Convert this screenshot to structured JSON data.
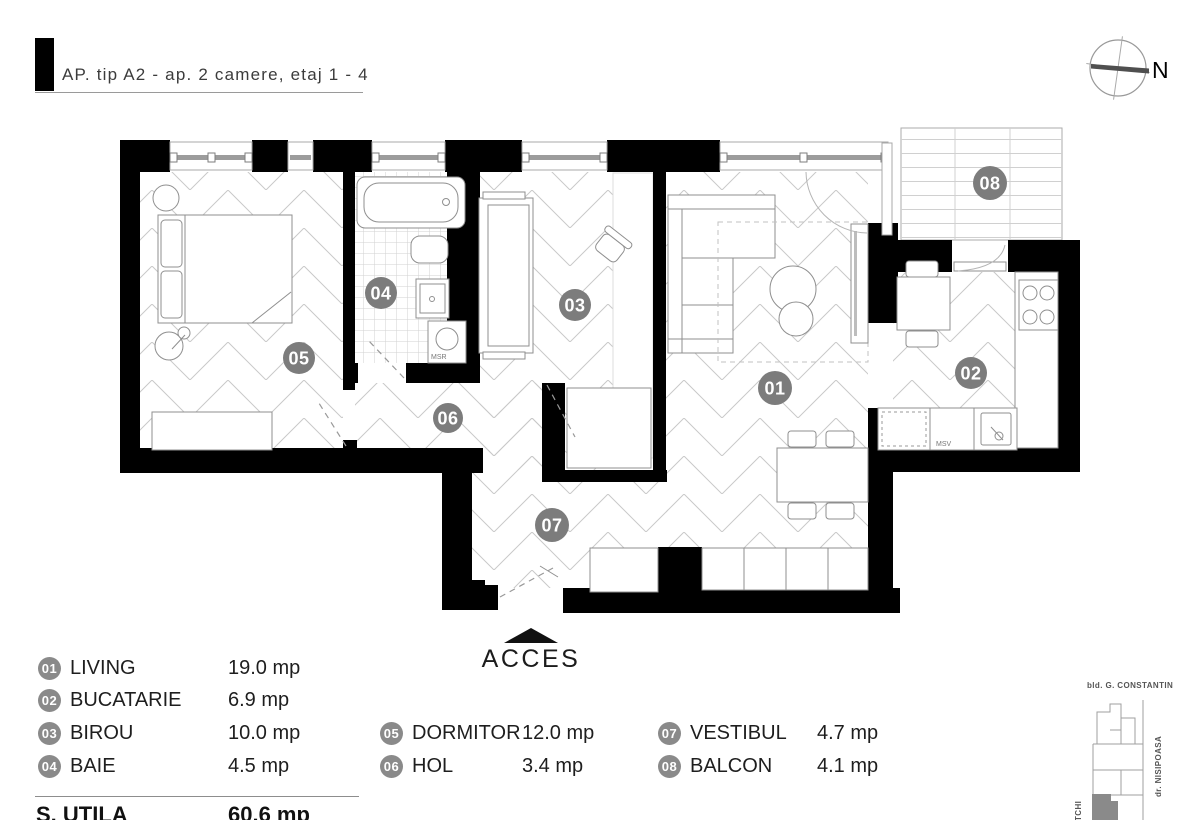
{
  "header": {
    "title": "AP. tip A2 - ap. 2 camere, etaj 1 - 4"
  },
  "compass": {
    "north_label": "N"
  },
  "rooms": [
    {
      "num": "01",
      "name": "LIVING",
      "area": "19.0 mp"
    },
    {
      "num": "02",
      "name": "BUCATARIE",
      "area": "6.9 mp"
    },
    {
      "num": "03",
      "name": "BIROU",
      "area": "10.0 mp"
    },
    {
      "num": "04",
      "name": "BAIE",
      "area": "4.5 mp"
    },
    {
      "num": "05",
      "name": "DORMITOR",
      "area": "12.0 mp"
    },
    {
      "num": "06",
      "name": "HOL",
      "area": "3.4 mp"
    },
    {
      "num": "07",
      "name": "VESTIBUL",
      "area": "4.7 mp"
    },
    {
      "num": "08",
      "name": "BALCON",
      "area": "4.1 mp"
    }
  ],
  "plan": {
    "washer_label": "MSR",
    "dishwasher_label": "MSV",
    "access_label": "ACCES"
  },
  "total": {
    "label": "S. UTILA",
    "value": "60.6 mp"
  },
  "sitemap": {
    "street_top": "bld. G. CONSTANTIN",
    "street_right": "dr. NISIPOASA",
    "street_left": "TCHI"
  },
  "colors": {
    "wall": "#000000",
    "badge": "#7c7c7c",
    "accent_gray": "#8a8a8a"
  }
}
